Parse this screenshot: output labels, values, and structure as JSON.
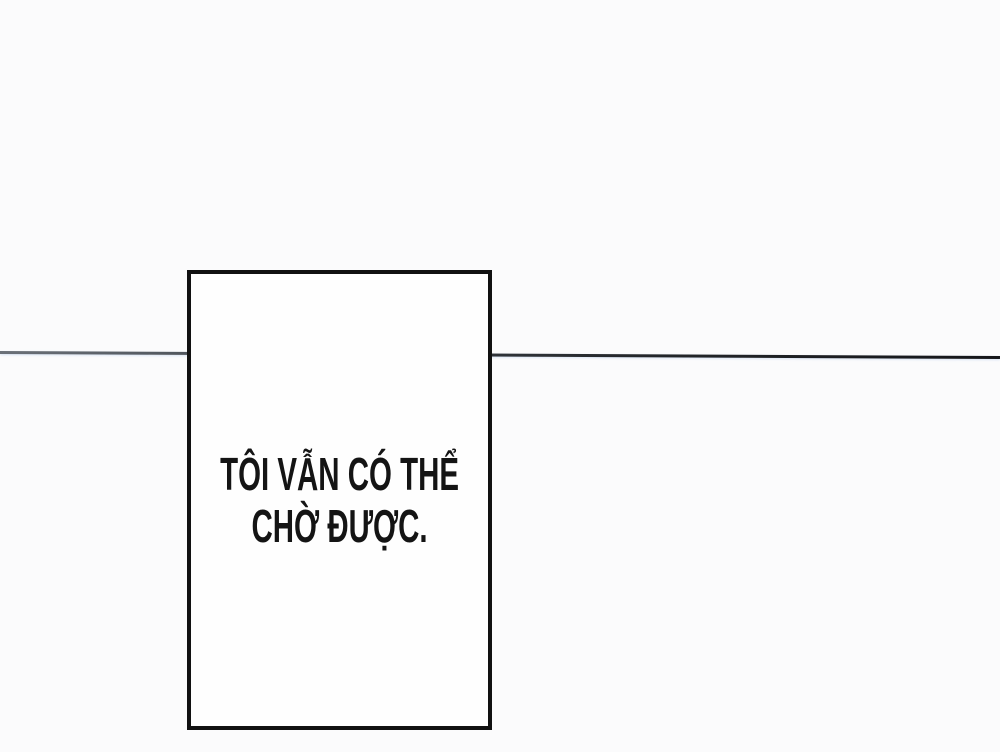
{
  "page": {
    "background_color": "#fbfbfc",
    "type": "comic-page"
  },
  "divider_line": {
    "color_left": "#6a7078",
    "color_right": "#15161a",
    "thickness_px": 3
  },
  "dialogue_box": {
    "border_color": "#111111",
    "fill_color": "#fefefe",
    "text_color": "#141414",
    "lines": [
      "TÔI VẪN CÓ THỂ",
      "CHỜ ĐƯỢC."
    ],
    "full_text": "TÔI VẪN CÓ THỂ CHỜ ĐƯỢC."
  }
}
